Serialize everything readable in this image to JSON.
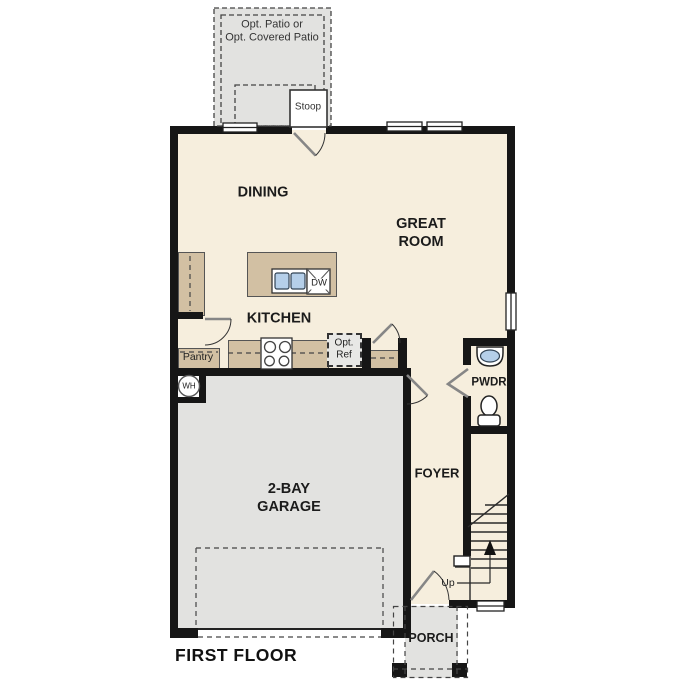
{
  "footer": {
    "plan_label": "FIRST FLOOR"
  },
  "colors": {
    "wall": "#161616",
    "floor": "#f6eedd",
    "garage": "#e2e2e0",
    "porch": "#e2e2e0",
    "patio": "#e2e2e0",
    "cabinet": "#d2c0a3",
    "sink_blue": "#b5cfe9",
    "dash": "#444444"
  },
  "rooms": {
    "dining": {
      "label": "DINING"
    },
    "great_room": {
      "label_line1": "GREAT",
      "label_line2": "ROOM"
    },
    "kitchen": {
      "label": "KITCHEN"
    },
    "garage": {
      "label_line1": "2-BAY",
      "label_line2": "GARAGE"
    },
    "foyer": {
      "label": "FOYER"
    },
    "powder_room": {
      "label": "PWDR"
    },
    "porch": {
      "label": "PORCH"
    },
    "pantry": {
      "label": "Pantry"
    },
    "stoop": {
      "label": "Stoop"
    },
    "patio": {
      "label_line1": "Opt. Patio or",
      "label_line2": "Opt. Covered Patio"
    }
  },
  "fixtures": {
    "dishwasher": "DW",
    "water_heater": "WH",
    "opt_ref_line1": "Opt.",
    "opt_ref_line2": "Ref",
    "stairs_direction": "Up"
  }
}
